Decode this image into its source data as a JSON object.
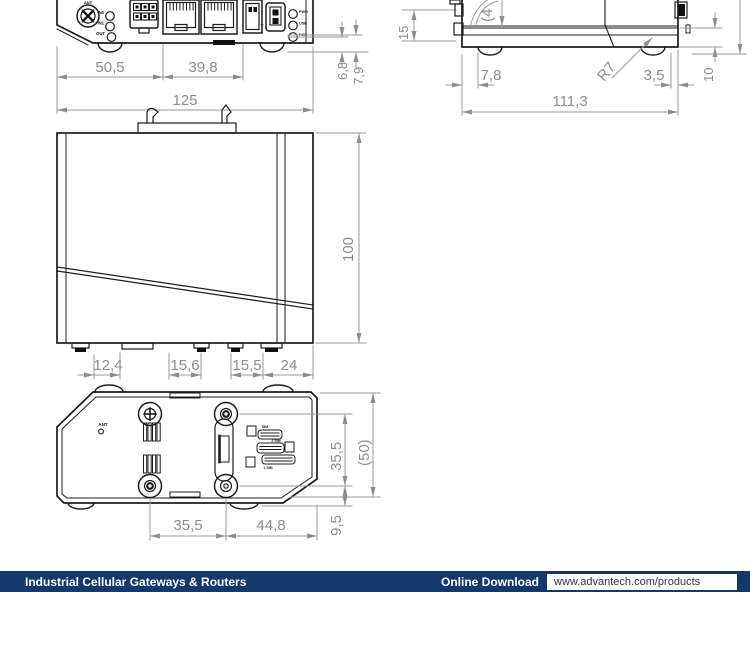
{
  "accent_color": "#14386C",
  "line_color": "#1c1c1c",
  "dim_color": "#8d8d8d",
  "front_view": {
    "dims": {
      "width_left": "50,5",
      "width_mid": "39,8",
      "width_total": "125",
      "v_small1": "6,8",
      "v_small2": "7,9",
      "v_clip": "15"
    },
    "labels": {
      "ant": "ANT",
      "in0": "IN0",
      "in1": "IN1",
      "out": "OUT",
      "minus": "-",
      "plus": "+",
      "led1": "PWR",
      "led2": "USB",
      "led3": "POE"
    }
  },
  "side_view": {
    "dims": {
      "foot_offset": "7,8",
      "chamfer": "3,5",
      "depth_total": "111,3",
      "radius": "R7",
      "base_height": "10",
      "clipped": "(4"
    }
  },
  "top_view": {
    "dims": {
      "foot1": "12,4",
      "foot2": "15,6",
      "foot3": "15,5",
      "foot4": "24",
      "height_total": "100"
    }
  },
  "bottom_view": {
    "dims": {
      "screw_span_h": "35,5",
      "screw_to_edge": "44,8",
      "screw_span_v": "35,5",
      "body_depth": "(50)",
      "edge_offset": "9,5"
    },
    "labels": {
      "ant": "ANT",
      "sim2": "2 SIM",
      "sim1": "1 SIM",
      "sim_top": "SIM"
    }
  },
  "footer": {
    "title": "Industrial Cellular Gateways & Routers",
    "download_label": "Online Download",
    "url": "www.advantech.com/products"
  }
}
